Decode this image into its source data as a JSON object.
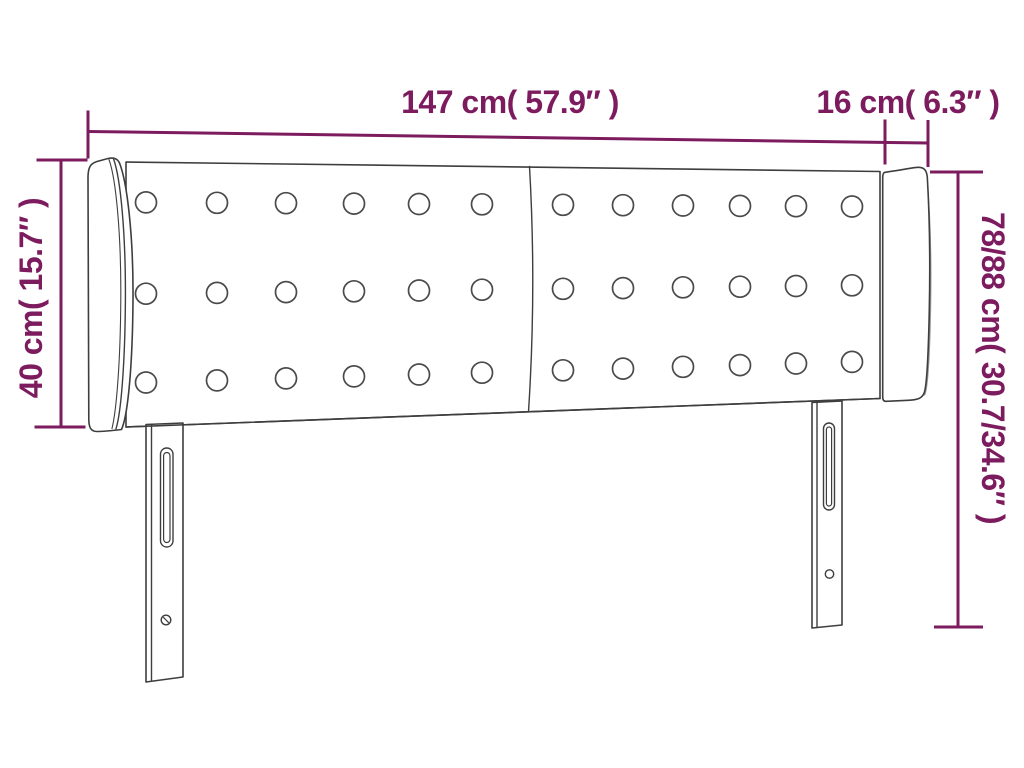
{
  "title": "Headboard dimension diagram",
  "dimensions": {
    "width": {
      "label": "147 cm( 57.9″ )",
      "cm": "147",
      "inches": "57.9"
    },
    "wing_depth": {
      "label": "16 cm( 6.3″ )",
      "cm": "16",
      "inches": "6.3"
    },
    "panel_height": {
      "label": "40 cm( 15.7″ )",
      "cm": "40",
      "inches": "15.7"
    },
    "total_height": {
      "label": "78/88 cm( 30.7/34.6″ )",
      "cm": "78/88",
      "inches": "30.7/34.6"
    }
  },
  "figure": {
    "tuft_buttons": {
      "rows": 3,
      "columns": 12
    },
    "panels": 2,
    "legs": 2
  },
  "colors": {
    "dimension": "#7c1b5e",
    "outline": "#3e3e3e",
    "shadow": "#979797",
    "background": "#ffffff"
  }
}
